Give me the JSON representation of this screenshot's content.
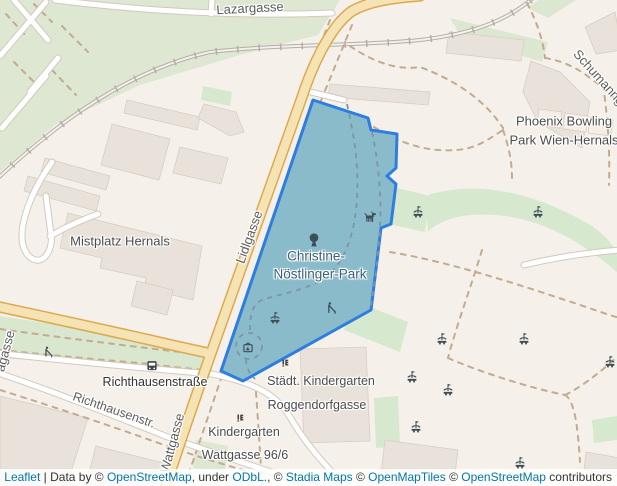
{
  "labels": {
    "lazargasse": "Lazargasse",
    "schumanngasse": "Schumanngasse",
    "lidlgasse": "Lidlgasse",
    "wattgasse": "Wattgasse",
    "gasse_partial": "agasse",
    "richthausenstr_short": "Richthausenstr.",
    "richthausenstrasse_stop": "Richthausenstraße",
    "mistplatz_hernals": "Mistplatz Hernals",
    "phoenix_bowling_line1": "Phoenix Bowling",
    "phoenix_bowling_line2": "Park Wien-Hernals",
    "park_line1": "Christine-",
    "park_line2": "Nöstlinger-Park",
    "kindergarten1_line1": "Städt. Kindergarten",
    "kindergarten1_line2": "Roggendorfgasse",
    "kindergarten2_line1": "Kindergarten",
    "kindergarten2_line2": "Wattgasse 96/6"
  },
  "attribution": {
    "leaflet": "Leaflet",
    "data_by": " | Data by © ",
    "osm": "OpenStreetMap",
    "under": ", under ",
    "odbl": "ODbL.",
    "sep2": ", © ",
    "stadia": "Stadia Maps",
    "copy1": " © ",
    "openmaptiles": "OpenMapTiles",
    "copy2": " © ",
    "osm2": "OpenStreetMap",
    "contributors": " contributors"
  },
  "colors": {
    "park_highlight_stroke": "#2e7de0",
    "park_highlight_fill": "rgba(51,136,255,0.35)",
    "link_blue": "#0078a8",
    "road_primary_casing": "#dca94f",
    "road_primary_fill": "#f6e3b4",
    "green_area": "#d6e8cd",
    "building_fill": "#e9e2da",
    "land": "#f5f1ea"
  }
}
